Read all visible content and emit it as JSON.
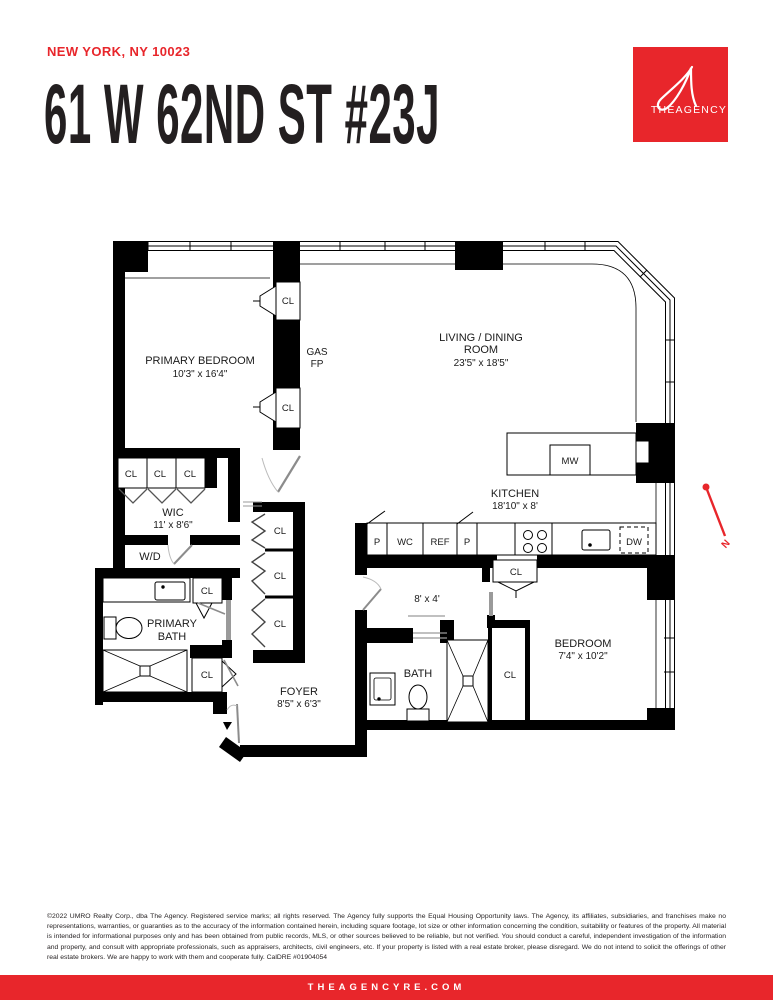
{
  "header": {
    "location": "NEW YORK, NY 10023",
    "address": "61 W 62ND ST #23J"
  },
  "logo": {
    "brand": "THEAGENCY"
  },
  "colors": {
    "accent_red": "#e8262b",
    "wall_black": "#000000",
    "title_ink": "#231f20"
  },
  "plan": {
    "rooms": {
      "primary_bedroom": {
        "name": "PRIMARY BEDROOM",
        "dims": "10'3\" x 16'4\""
      },
      "living_dining": {
        "line1": "LIVING / DINING",
        "line2": "ROOM",
        "dims": "23'5\" x 18'5\""
      },
      "gas_fp": {
        "line1": "GAS",
        "line2": "FP"
      },
      "kitchen": {
        "name": "KITCHEN",
        "dims": "18'10\" x 8'"
      },
      "wic": {
        "name": "WIC",
        "dims": "11' x 8'6\""
      },
      "wd": {
        "name": "W/D"
      },
      "primary_bath": {
        "line1": "PRIMARY",
        "line2": "BATH"
      },
      "hall": {
        "dims": "8' x 4'"
      },
      "bath": {
        "name": "BATH"
      },
      "bedroom": {
        "name": "BEDROOM",
        "dims": "7'4\" x 10'2\""
      },
      "foyer": {
        "name": "FOYER",
        "dims": "8'5\" x 6'3\""
      }
    },
    "labels": {
      "closet": "CL",
      "microwave": "MW",
      "dishwasher": "DW",
      "pantry": "P",
      "water_closet": "WC",
      "refrigerator": "REF",
      "north": "N"
    }
  },
  "disclaimer": {
    "text": "©2022 UMRO Realty Corp., dba The Agency. Registered service marks; all rights reserved. The Agency fully supports the Equal Housing Opportunity laws. The Agency, its affiliates, subsidiaries, and franchises make no representations, warranties, or guaranties as to the accuracy of the information contained herein, including square footage, lot size or other information concerning the condition, suitability or features of the property. All material is intended for informational purposes only and has been obtained from public records, MLS, or other sources believed to be reliable, but not verified. You should conduct a careful, independent investigation of the information and property, and consult with appropriate professionals, such as appraisers, architects, civil engineers, etc. If your property is listed with a real estate broker, please disregard. We do not intend to solicit the offerings of other real estate brokers. We are happy to work with them and cooperate fully. CalDRE #01904054"
  },
  "footer": {
    "website": "THEAGENCYRE.COM"
  }
}
